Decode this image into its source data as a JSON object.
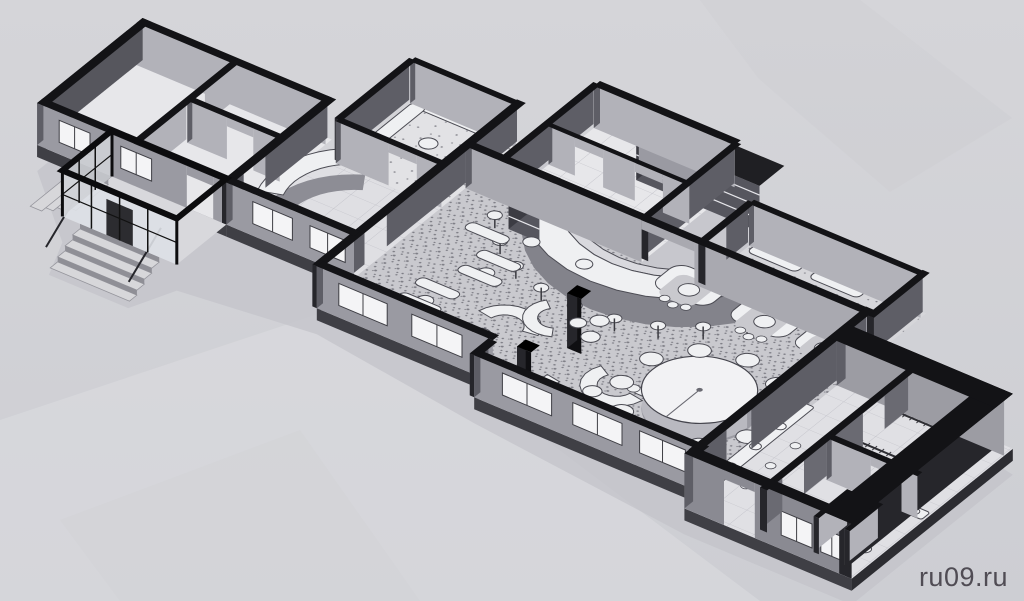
{
  "watermark": {
    "label": "ru09.ru",
    "color": "#46424a"
  },
  "palette": {
    "background_top": "#d5d5d9",
    "background_bottom": "#cdced3",
    "paper_sheen": "#dedee1",
    "ground_shadow": "#c3c3c9",
    "wall_top": "#131316",
    "wall_facade": "#9a9aa2",
    "wall_interior": "#b2b2b9",
    "wall_dark": "#5e5e66",
    "wall_darkest": "#26262b",
    "slab": "#3f3f45",
    "floor_room": "#e7e7ea",
    "floor_hall": "#c9c9ce",
    "floor_dot": "#7e7e86",
    "tile_line": "#c2c2c9",
    "furniture_fill": "#eff0f2",
    "furniture_stroke": "#4c4c54",
    "glass": "#dde0e5",
    "window_fill": "#f4f4f6",
    "step_top": "#d7d7da",
    "step_riser": "#9a9aa1"
  },
  "scene": {
    "kind": "isometric floor plan drawing",
    "features": [
      "entrance-porch",
      "entrance-stairs",
      "reception-desk",
      "curved-bar-counter",
      "bar-stools",
      "back-bar-shelves",
      "lounge-sofas",
      "dining-tables",
      "banquet-round-table",
      "booth-seating",
      "columns",
      "restroom-sinks",
      "toilet-stalls",
      "wardrobe-racks",
      "service-rooms"
    ]
  }
}
